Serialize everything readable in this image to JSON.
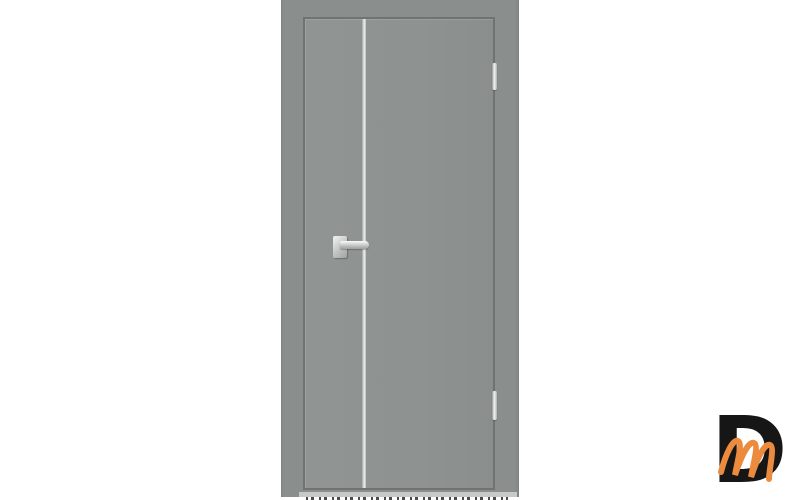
{
  "colors": {
    "background": "#FFFFFF",
    "door": "#8E9290",
    "frame": "#8A8E8C",
    "gap": "#6F7472",
    "molding": "#ECEEEC",
    "hardware": "#C3C7C5"
  },
  "product": {
    "subject": "grey-interior-door",
    "hardware": {
      "handle": "chrome-lever-handle",
      "molding": "vertical-aluminum-strip",
      "hinges_count": 2
    }
  },
  "watermark": {
    "letter_d": "D",
    "letter_m": "m",
    "black": "#161616",
    "orange": "#EC8B3D"
  }
}
